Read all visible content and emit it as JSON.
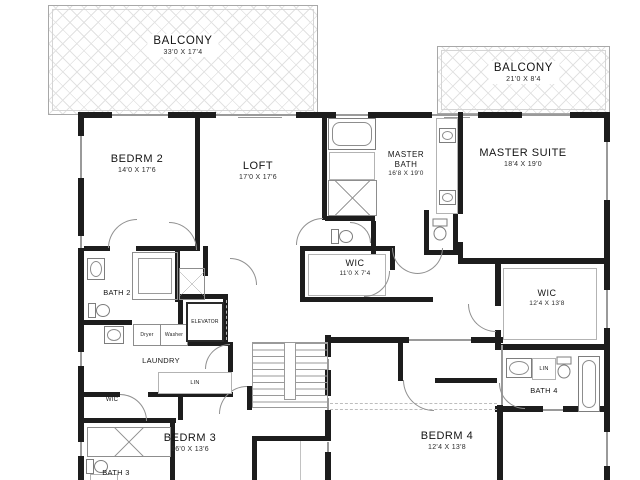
{
  "style": {
    "wall_color": "#1d1d1d",
    "line_color": "#9a9a9a",
    "hatch_color": "#e2e2e2",
    "background": "#ffffff"
  },
  "rooms": {
    "balcony_left": {
      "name": "BALCONY",
      "dims": "33'0 X 17'4"
    },
    "balcony_right": {
      "name": "BALCONY",
      "dims": "21'0 X 8'4"
    },
    "bedrm2": {
      "name": "BEDRM 2",
      "dims": "14'0 X 17'6"
    },
    "loft": {
      "name": "LOFT",
      "dims": "17'0 X 17'6"
    },
    "master_bath": {
      "name": "MASTER BATH",
      "dims": "16'8 X 19'0"
    },
    "master_suite": {
      "name": "MASTER SUITE",
      "dims": "18'4 X 19'0"
    },
    "wic_center": {
      "name": "WIC",
      "dims": "11'0 X 7'4"
    },
    "wic_right": {
      "name": "WIC",
      "dims": "12'4 X 13'8"
    },
    "bath2": {
      "name": "BATH 2"
    },
    "elevator": {
      "name": "ELEVATOR"
    },
    "dryer": {
      "name": "Dryer"
    },
    "washer": {
      "name": "Washer"
    },
    "laundry": {
      "name": "LAUNDRY"
    },
    "lin_left": {
      "name": "LIN"
    },
    "wic_small": {
      "name": "WIC"
    },
    "bedrm3": {
      "name": "BEDRM 3",
      "dims": "16'0 X 13'6"
    },
    "bath3": {
      "name": "BATH 3"
    },
    "bedrm4": {
      "name": "BEDRM 4",
      "dims": "12'4 X 13'8"
    },
    "bath4": {
      "name": "BATH 4"
    },
    "lin_right": {
      "name": "LIN"
    }
  }
}
